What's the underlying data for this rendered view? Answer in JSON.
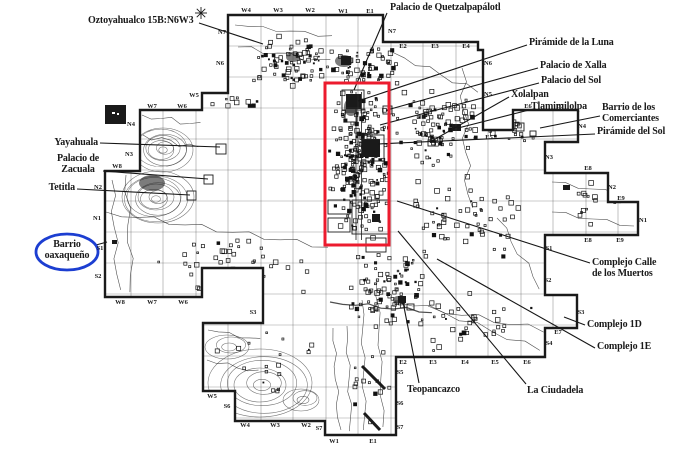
{
  "page": {
    "background": "#ffffff"
  },
  "map": {
    "ink": "#1a1a1a",
    "highlight_box": {
      "color": "#ec1b2e",
      "x": 325,
      "y": 83,
      "width": 64,
      "height": 162,
      "stroke_width": 3
    },
    "blue_circle": {
      "color": "#1c3ed1",
      "cx": 67,
      "cy": 252,
      "rx": 31,
      "ry": 18,
      "stroke_width": 2.8
    },
    "site_labels": [
      {
        "id": "oztoyahualco",
        "lines": [
          "Oztoyahualco 15B:N6W3"
        ],
        "x": 88,
        "y": 16,
        "align": "left",
        "leader": [
          199,
          23,
          263,
          44
        ]
      },
      {
        "id": "palacio-quetzalpapalotl",
        "lines": [
          "Palacio de Quetzalpapálotl"
        ],
        "x": 390,
        "y": 3,
        "align": "left",
        "leader": [
          387,
          13,
          354,
          90
        ]
      },
      {
        "id": "piramide-de-la-luna",
        "lines": [
          "Pirámide de la Luna"
        ],
        "x": 529,
        "y": 38,
        "align": "left",
        "leader": [
          527,
          45,
          358,
          101
        ]
      },
      {
        "id": "palacio-de-xalla",
        "lines": [
          "Palacio de Xalla"
        ],
        "x": 540,
        "y": 61,
        "align": "left",
        "leader": [
          538,
          68,
          387,
          110
        ]
      },
      {
        "id": "palacio-del-sol",
        "lines": [
          "Palacio del Sol"
        ],
        "x": 541,
        "y": 76,
        "align": "left",
        "leader": [
          539,
          83,
          380,
          125
        ]
      },
      {
        "id": "xolalpan",
        "lines": [
          "Xolalpan"
        ],
        "x": 511,
        "y": 90,
        "align": "left",
        "leader": [
          509,
          97,
          430,
          142
        ]
      },
      {
        "id": "tlamimilolpa",
        "lines": [
          "Tlamimilolpa"
        ],
        "x": 531,
        "y": 102,
        "align": "left",
        "leader": [
          529,
          110,
          458,
          128
        ]
      },
      {
        "id": "barrio-de-los-comerciantes",
        "lines": [
          "Barrio de los",
          "Comerciantes"
        ],
        "x": 602,
        "y": 103,
        "align": "left",
        "leader": [
          600,
          116,
          540,
          128
        ]
      },
      {
        "id": "piramide-del-sol",
        "lines": [
          "Pirámide del Sol"
        ],
        "x": 597,
        "y": 127,
        "align": "left",
        "leader": [
          595,
          134,
          378,
          144
        ]
      },
      {
        "id": "complejo-calle-de-los-muertos",
        "lines": [
          "Complejo Calle",
          "de los Muertos"
        ],
        "x": 592,
        "y": 258,
        "align": "left",
        "leader": [
          590,
          263,
          397,
          201
        ]
      },
      {
        "id": "complejo-1d",
        "lines": [
          "Complejo 1D"
        ],
        "x": 587,
        "y": 320,
        "align": "left",
        "leader": [
          585,
          325,
          564,
          317
        ]
      },
      {
        "id": "complejo-1e",
        "lines": [
          "Complejo 1E"
        ],
        "x": 597,
        "y": 342,
        "align": "left",
        "leader": [
          595,
          348,
          437,
          259
        ]
      },
      {
        "id": "teopancazco",
        "lines": [
          "Teopancazco"
        ],
        "x": 407,
        "y": 385,
        "align": "left",
        "leader": [
          419,
          383,
          403,
          302
        ]
      },
      {
        "id": "la-ciudadela",
        "lines": [
          "La Ciudadela"
        ],
        "x": 527,
        "y": 386,
        "align": "left",
        "leader": [
          526,
          384,
          398,
          231
        ]
      },
      {
        "id": "yayahuala",
        "lines": [
          "Yayahuala"
        ],
        "x": 30,
        "y": 138,
        "w": 68,
        "align": "right",
        "leader": [
          100,
          143,
          220,
          147
        ]
      },
      {
        "id": "palacio-de-zacuala",
        "lines": [
          "Palacio de",
          "Zacuala"
        ],
        "x": 44,
        "y": 154,
        "w": 68,
        "align": "center",
        "leader": [
          103,
          171,
          208,
          179
        ]
      },
      {
        "id": "tetitla",
        "lines": [
          "Tetitla"
        ],
        "x": 20,
        "y": 183,
        "w": 55,
        "align": "right",
        "leader": [
          77,
          189,
          190,
          195
        ]
      },
      {
        "id": "barrio-oaxaqueno",
        "lines": [
          "Barrio",
          "oaxaqueño"
        ],
        "x": 27,
        "y": 240,
        "w": 80,
        "align": "center",
        "circled": true,
        "leader": [
          96,
          245,
          107,
          242
        ]
      }
    ],
    "grid_labels": [
      [
        "W4",
        246,
        10
      ],
      [
        "W3",
        278,
        10
      ],
      [
        "W2",
        310,
        10
      ],
      [
        "W1",
        343,
        11
      ],
      [
        "E1",
        370,
        11
      ],
      [
        "N7",
        222,
        32
      ],
      [
        "N6",
        220,
        63
      ],
      [
        "W5",
        194,
        95
      ],
      [
        "W7",
        152,
        106
      ],
      [
        "W6",
        182,
        106
      ],
      [
        "N4",
        131,
        124
      ],
      [
        "N3",
        129,
        154
      ],
      [
        "W8",
        117,
        166
      ],
      [
        "N2",
        98,
        187
      ],
      [
        "N1",
        97,
        218
      ],
      [
        "S1",
        100,
        248
      ],
      [
        "S2",
        98,
        276
      ],
      [
        "W8",
        120,
        302
      ],
      [
        "W7",
        152,
        302
      ],
      [
        "W6",
        183,
        302
      ],
      [
        "S3",
        253,
        312
      ],
      [
        "W5",
        212,
        396
      ],
      [
        "S6",
        227,
        406
      ],
      [
        "W4",
        245,
        425
      ],
      [
        "W3",
        275,
        425
      ],
      [
        "W2",
        306,
        425
      ],
      [
        "S7",
        319,
        428
      ],
      [
        "W1",
        334,
        441
      ],
      [
        "E1",
        373,
        441
      ],
      [
        "S5",
        400,
        372
      ],
      [
        "S6",
        400,
        403
      ],
      [
        "S7",
        400,
        427
      ],
      [
        "E2",
        403,
        362
      ],
      [
        "E3",
        433,
        362
      ],
      [
        "E4",
        465,
        362
      ],
      [
        "E5",
        495,
        362
      ],
      [
        "E6",
        527,
        362
      ],
      [
        "S4",
        549,
        343
      ],
      [
        "E7",
        558,
        332
      ],
      [
        "S3",
        581,
        312
      ],
      [
        "S2",
        548,
        280
      ],
      [
        "S1",
        549,
        248
      ],
      [
        "E8",
        588,
        240
      ],
      [
        "E9",
        620,
        240
      ],
      [
        "N1",
        643,
        220
      ],
      [
        "E9",
        621,
        198
      ],
      [
        "N2",
        612,
        187
      ],
      [
        "E8",
        588,
        168
      ],
      [
        "N3",
        549,
        157
      ],
      [
        "N4",
        582,
        126
      ],
      [
        "E6",
        528,
        106
      ],
      [
        "E7",
        560,
        106
      ],
      [
        "E5",
        489,
        137
      ],
      [
        "N5",
        488,
        94
      ],
      [
        "N6",
        488,
        63
      ],
      [
        "E2",
        403,
        46
      ],
      [
        "E3",
        435,
        46
      ],
      [
        "E4",
        466,
        46
      ],
      [
        "N7",
        392,
        31
      ]
    ]
  }
}
